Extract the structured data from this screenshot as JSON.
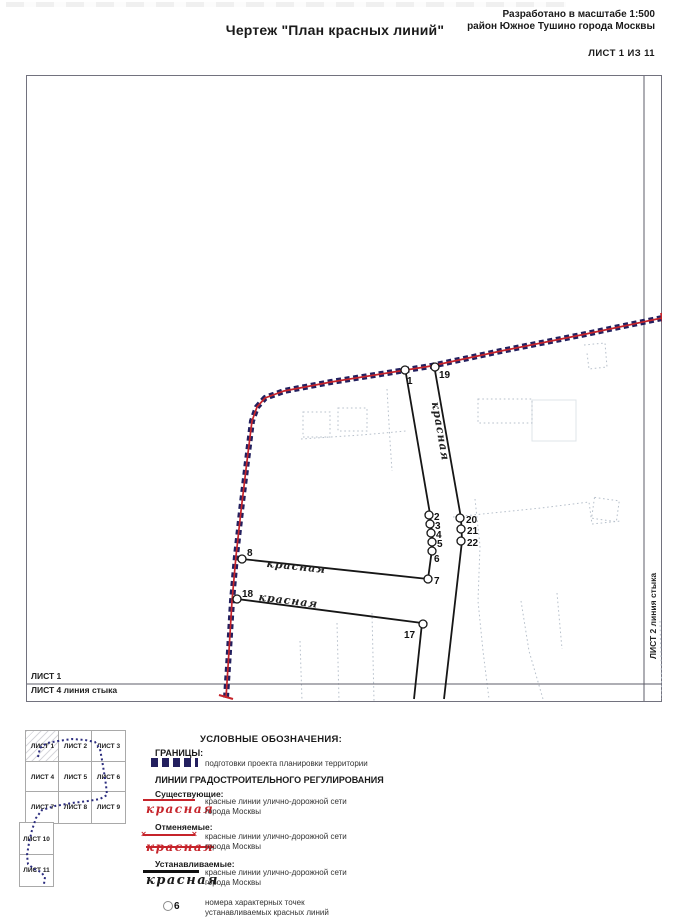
{
  "header": {
    "title": "Чертеж \"План красных линий\"",
    "subtitle_line1": "Разработано в масштабе 1:500",
    "subtitle_line2": "район Южное Тушино города Москвы",
    "sheet_label": "ЛИСТ 1 ИЗ 11"
  },
  "map": {
    "junction_labels": {
      "bottom_above": "ЛИСТ 1",
      "bottom_below": "ЛИСТ 4 линия стыка",
      "right": "ЛИСТ 2 линия стыка"
    },
    "boundary": {
      "points": "661,317 580,334 500,350 430,365 330,381 283,390 264,397 256,406 251,420 246,460 240,510 235,555 231,600 228,650 225,697",
      "ticks": [
        [
          218,
          694,
          232,
          698
        ],
        [
          660,
          312,
          662,
          322
        ]
      ]
    },
    "red_lines": [
      {
        "points": "404,367 429,513 432,541 427,578 241,558"
      },
      {
        "points": "433,364 460,517 461,540 443,698"
      },
      {
        "points": "236,598 421,622 413,698"
      }
    ],
    "points": [
      {
        "n": "1",
        "cx": 404,
        "cy": 369,
        "lx": 406,
        "ly": 383
      },
      {
        "n": "19",
        "cx": 434,
        "cy": 366,
        "lx": 438,
        "ly": 377
      },
      {
        "n": "2",
        "cx": 428,
        "cy": 514,
        "lx": 433,
        "ly": 519
      },
      {
        "n": "3",
        "cx": 429,
        "cy": 523,
        "lx": 434,
        "ly": 528
      },
      {
        "n": "4",
        "cx": 430,
        "cy": 532,
        "lx": 435,
        "ly": 537
      },
      {
        "n": "5",
        "cx": 431,
        "cy": 541,
        "lx": 436,
        "ly": 546
      },
      {
        "n": "6",
        "cx": 431,
        "cy": 550,
        "lx": 433,
        "ly": 561
      },
      {
        "n": "7",
        "cx": 427,
        "cy": 578,
        "lx": 433,
        "ly": 583
      },
      {
        "n": "8",
        "cx": 241,
        "cy": 558,
        "lx": 246,
        "ly": 555
      },
      {
        "n": "18",
        "cx": 236,
        "cy": 598,
        "lx": 241,
        "ly": 596
      },
      {
        "n": "17",
        "cx": 422,
        "cy": 623,
        "lx": 403,
        "ly": 637
      },
      {
        "n": "20",
        "cx": 459,
        "cy": 517,
        "lx": 465,
        "ly": 522
      },
      {
        "n": "21",
        "cx": 460,
        "cy": 528,
        "lx": 466,
        "ly": 533
      },
      {
        "n": "22",
        "cx": 460,
        "cy": 540,
        "lx": 466,
        "ly": 545
      }
    ],
    "street_labels": [
      {
        "text": "красная",
        "x": 436,
        "y": 431,
        "rotate": 80
      },
      {
        "text": "красная",
        "x": 295,
        "y": 569,
        "rotate": 6
      },
      {
        "text": "красная",
        "x": 287,
        "y": 603,
        "rotate": 7
      }
    ]
  },
  "sheet_index": {
    "cells": [
      {
        "label": "ЛИСТ 1",
        "x": 25,
        "y": 730,
        "w": 33,
        "h": 31,
        "hatched": true
      },
      {
        "label": "ЛИСТ 2",
        "x": 58,
        "y": 730,
        "w": 33,
        "h": 31
      },
      {
        "label": "ЛИСТ 3",
        "x": 91,
        "y": 730,
        "w": 33,
        "h": 31
      },
      {
        "label": "ЛИСТ 4",
        "x": 25,
        "y": 761,
        "w": 33,
        "h": 30
      },
      {
        "label": "ЛИСТ 5",
        "x": 58,
        "y": 761,
        "w": 33,
        "h": 30
      },
      {
        "label": "ЛИСТ 6",
        "x": 91,
        "y": 761,
        "w": 33,
        "h": 30
      },
      {
        "label": "ЛИСТ 7",
        "x": 25,
        "y": 791,
        "w": 33,
        "h": 31
      },
      {
        "label": "ЛИСТ 8",
        "x": 58,
        "y": 791,
        "w": 33,
        "h": 31
      },
      {
        "label": "ЛИСТ 9",
        "x": 91,
        "y": 791,
        "w": 33,
        "h": 31
      },
      {
        "label": "ЛИСТ 10",
        "x": 19,
        "y": 822,
        "w": 33,
        "h": 32
      },
      {
        "label": "ЛИСТ 11",
        "x": 19,
        "y": 854,
        "w": 33,
        "h": 31
      }
    ],
    "path": "38,757 40,748 47,743 58,741 72,739 85,740 95,742 100,749 102,760 104,772 106,785 107,795 100,799 88,801 72,803 55,806 42,810 36,818 32,830 29,843 27,855 28,864 34,869 41,872 45,877 44,884"
  },
  "legend": {
    "title": "УСЛОВНЫЕ ОБОЗНАЧЕНИЯ:",
    "borders_heading": "ГРАНИЦЫ:",
    "borders_desc": "подготовки проекта планировки территории",
    "lines_heading": "ЛИНИИ ГРАДОСТРОИТЕЛЬНОГО РЕГУЛИРОВАНИЯ",
    "existing": {
      "heading": "Существующие:",
      "swatch_label": "красная",
      "desc1": "красные линии улично-дорожной сети",
      "desc2": "города Москвы"
    },
    "cancelled": {
      "heading": "Отменяемые:",
      "swatch_label": "красная",
      "desc1": "красные линии улично-дорожной сети",
      "desc2": "города Москвы"
    },
    "established": {
      "heading": "Устанавливаемые:",
      "swatch_label": "красная",
      "desc1": "красные линии улично-дорожной сети",
      "desc2": "города Москвы"
    },
    "points": {
      "symbol": "6",
      "desc1": "номера характерных точек",
      "desc2": "устанавливаемых красных линий"
    }
  },
  "colors": {
    "boundary_square": "#23205f",
    "red_line": "#c6242b",
    "established_line": "#161616"
  }
}
